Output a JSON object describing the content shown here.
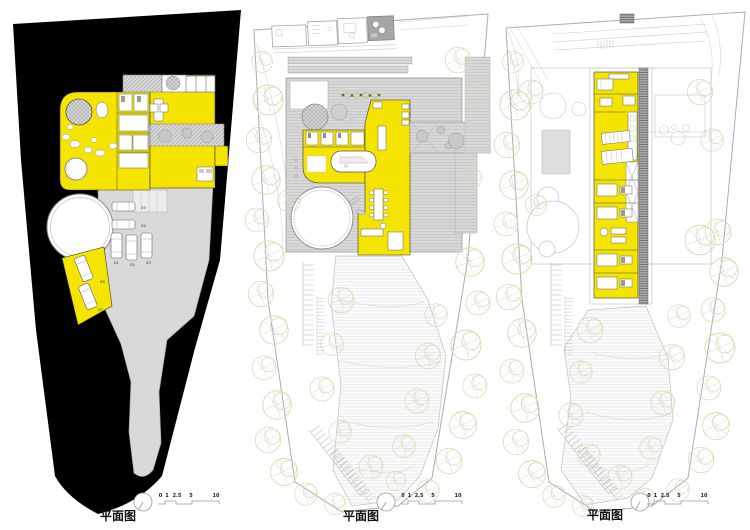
{
  "sheet": {
    "background": "#ffffff"
  },
  "colors": {
    "highlight_yellow": "#F4E400",
    "site_mass_black": "#000000",
    "paving_gray": "#D9D9D9",
    "tree_outline_green": "#D6DFAE",
    "linework_gray": "#BDBDBD"
  },
  "icons": {
    "north_indicator": "circle-with-needle",
    "tree": "overlapping-outline-circles",
    "car": "rounded-rect-vehicle",
    "scale_bar": "stepped-profile-line"
  },
  "panels": [
    {
      "name": "site-plan-entry-level",
      "label": "平面图",
      "scale_ticks": [
        "0",
        "1",
        "2.5",
        "5",
        "10"
      ],
      "parking_spots": [
        "01",
        "02",
        "03",
        "04",
        "05",
        "06",
        "07"
      ]
    },
    {
      "name": "site-plan-main-level",
      "label": "平面图",
      "scale_ticks": [
        "0",
        "1",
        "2.5",
        "5",
        "10"
      ]
    },
    {
      "name": "site-plan-upper-level",
      "label": "平面图",
      "scale_ticks": [
        "0",
        "1",
        "2.5",
        "5",
        "10"
      ]
    }
  ]
}
